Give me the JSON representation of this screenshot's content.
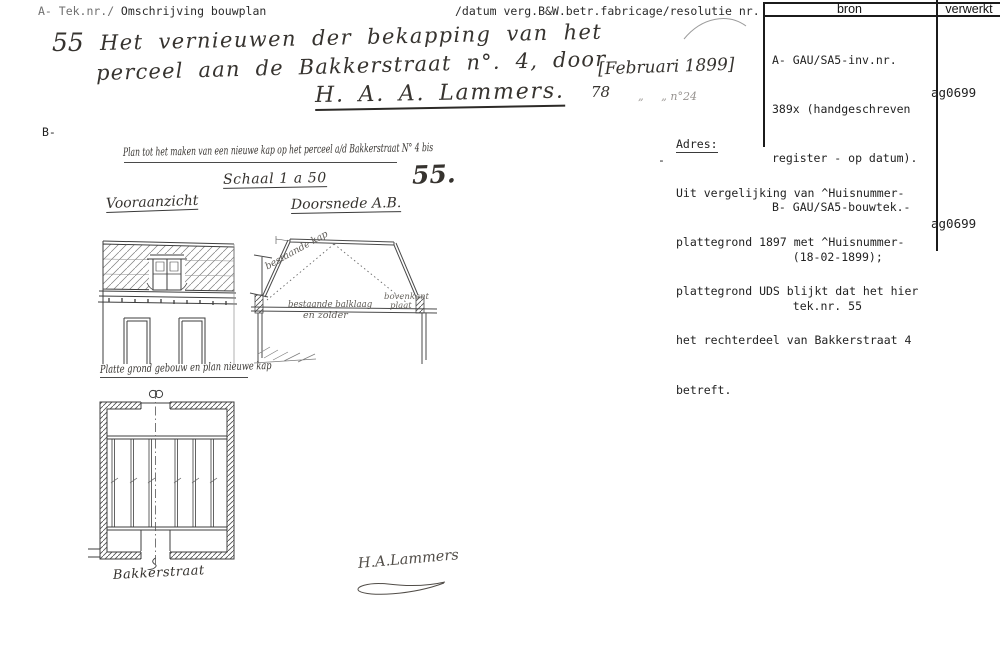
{
  "header": {
    "left_light": "A- Tek.nr./",
    "left_dark": " Omschrijving bouwplan",
    "middle": "/datum verg.B&W.betr.fabricage/resolutie nr.",
    "col_bron": "bron",
    "col_verwerkt": "verwerkt"
  },
  "entry": {
    "number": "55",
    "line1": "Het vernieuwen der bekapping van het",
    "line2": "perceel aan de Bakkerstraat n°. 4, door",
    "line3": "H. A. A. Lammers.",
    "date": "[Februari 1899]",
    "date_day": "78",
    "date_rest": "„     „ n°24"
  },
  "bron": {
    "lines": [
      "A- GAU/SA5-inv.nr.",
      "389x (handgeschreven",
      "register - op datum).",
      "B- GAU/SA5-bouwtek.-",
      "   (18-02-1899);",
      "   tek.nr. 55"
    ],
    "verwerkt": "ag0699"
  },
  "adres": {
    "label": "Adres:",
    "dash": "-",
    "lines": [
      "Uit vergelijking van ^Huisnummer-",
      "plattegrond 1897 met ^Huisnummer-",
      "plattegrond UDS blijkt dat het hier",
      "het rechterdeel van Bakkerstraat 4",
      "betreft."
    ],
    "verwerkt": "ag0699"
  },
  "drawing": {
    "b_label": "B-",
    "title": "Plan tot het maken van een nieuwe kap op het perceel a/d Bakkerstraat N° 4 bis",
    "scale": "Schaal 1 a 50",
    "sheet_number": "55.",
    "front_label": "Vooraanzicht",
    "section_label": "Doorsnede A.B.",
    "plan_label": "Platte grond gebouw en plan nieuwe kap",
    "street_label": "Bakkerstraat",
    "signature": "H.A.Lammers",
    "note_kap": "bestaande kap",
    "note_balklaag": "bestaande balklaag",
    "note_zolder": "en zolder",
    "note_right1": "bovenkant",
    "note_right2": "plaat"
  }
}
